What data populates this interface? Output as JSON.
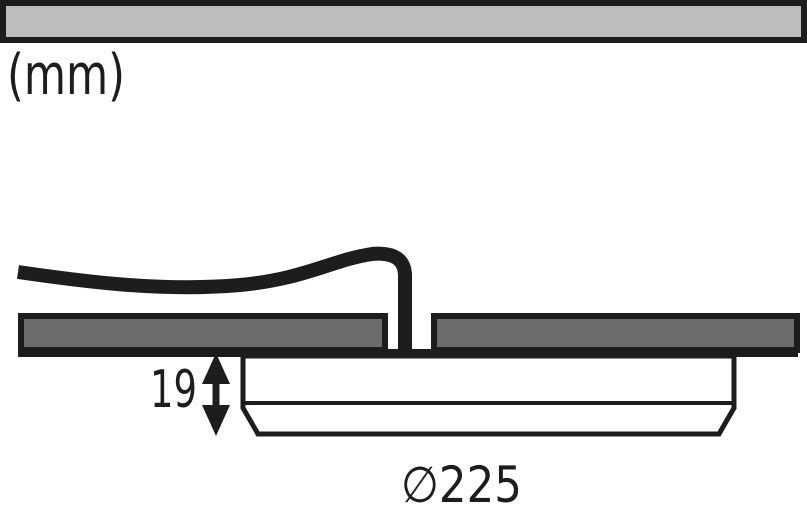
{
  "diagram": {
    "unit_label": "(mm)",
    "height_label": "19",
    "diameter_label": "∅225",
    "colors": {
      "line": "#1d1d1f",
      "surface": "#bcbdbf",
      "panel": "#6b6c6e",
      "fixture": "#ffffff",
      "background": "#ffffff"
    }
  }
}
